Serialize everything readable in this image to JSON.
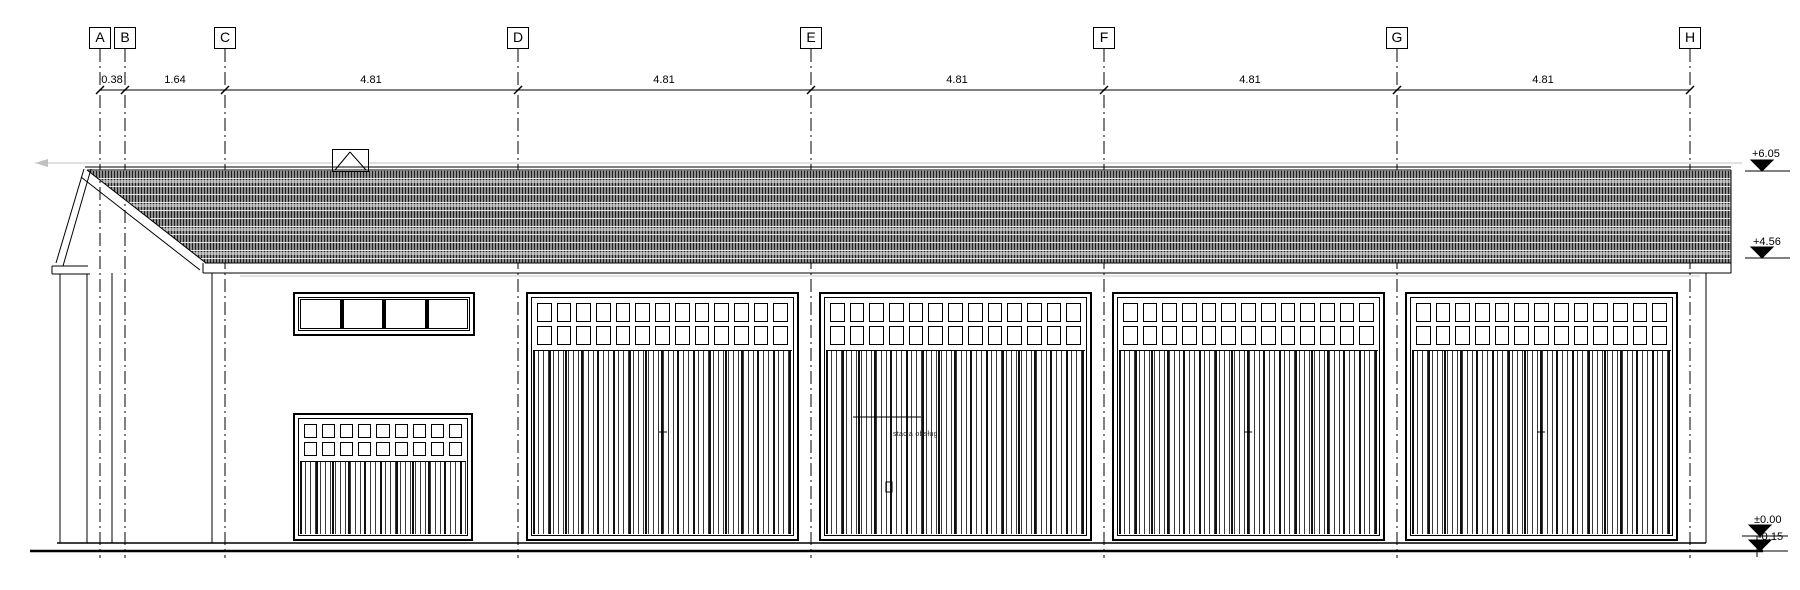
{
  "grid": {
    "labels": [
      "A",
      "B",
      "C",
      "D",
      "E",
      "F",
      "G",
      "H"
    ]
  },
  "dimensions": {
    "values": [
      "0.38",
      "1.64",
      "4.81",
      "4.81",
      "4.81",
      "4.81",
      "4.81"
    ]
  },
  "levels": {
    "values": [
      "+6.05",
      "+4.56",
      "±0.00",
      "-0.15"
    ]
  },
  "annotation": {
    "door_text": "stacja obsługi"
  },
  "colors": {
    "line": "#000000",
    "faint_reference": "#c0c0c0",
    "roof_base": "#8f8f8f"
  }
}
